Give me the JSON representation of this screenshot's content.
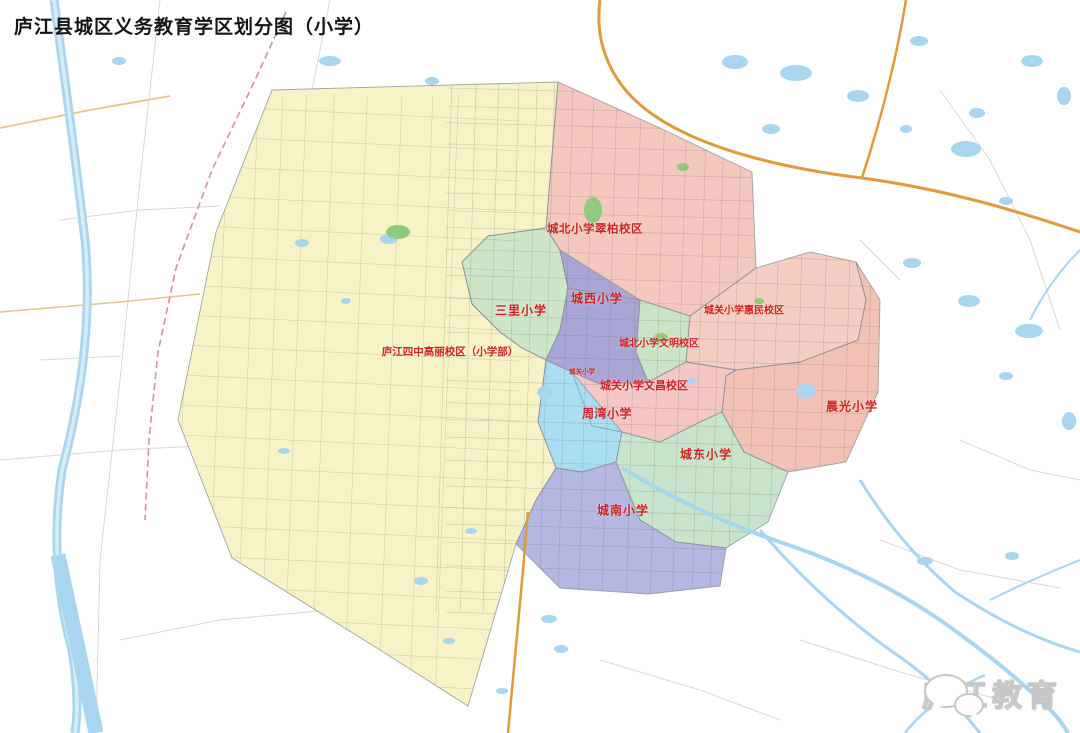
{
  "title": "庐江县城区义务教育学区划分图（小学）",
  "watermark": {
    "text": "庐江教育",
    "icon": "wechat-icon"
  },
  "palette": {
    "label_red": "#cc2222",
    "water": "#a8d5ef",
    "water_light": "#d6edf9",
    "green_patch": "#8fca7e",
    "road_orange": "#df9a3e",
    "road_ochre": "#e3c48c",
    "railway_pink": "#d98f98",
    "rural_road": "#d8d4c6",
    "zone_outline": "#8a8f9a",
    "title_color": "#141414"
  },
  "zones": [
    {
      "id": "sizhong",
      "school": "庐江四中高丽校区（小学部）",
      "color": "#f8f3c6",
      "label": {
        "x": 450,
        "y": 353,
        "size": 10.5,
        "spacing": 0
      },
      "points": "272,90 558,82 546,228 488,236 462,262 472,304 500,332 522,348 546,360 538,422 556,468 536,500 516,544 468,706 380,650 232,558 178,420 216,232"
    },
    {
      "id": "chengbei-cuibai",
      "school": "城北小学翠柏校区",
      "color": "#f4c8be",
      "label": {
        "x": 595,
        "y": 230,
        "size": 11.5,
        "spacing": 0.5
      },
      "points": "558,82 660,128 752,172 756,268 690,316 640,300 568,288 560,250 546,228"
    },
    {
      "id": "sanli",
      "school": "三里小学",
      "color": "#cee6c8",
      "label": {
        "x": 521,
        "y": 311,
        "size": 12,
        "spacing": 1
      },
      "points": "488,236 546,228 560,250 568,288 560,330 546,360 522,348 500,332 472,304 462,262"
    },
    {
      "id": "chengxi",
      "school": "城西小学",
      "color": "#a9a6d6",
      "label": {
        "x": 597,
        "y": 299,
        "size": 12,
        "spacing": 1
      },
      "points": "560,250 640,300 636,352 648,382 600,384 572,372 546,360 560,330 568,288"
    },
    {
      "id": "chengbei-wenming",
      "school": "城北小学文明校区",
      "color": "#cbe4c6",
      "label": {
        "x": 659,
        "y": 344,
        "size": 10,
        "spacing": 0
      },
      "points": "640,300 690,316 686,362 648,382 636,352"
    },
    {
      "id": "chengguan-huimin",
      "school": "城关小学惠民校区",
      "color": "#f5cdc2",
      "label": {
        "x": 744,
        "y": 311,
        "size": 10,
        "spacing": 0
      },
      "points": "756,268 810,252 856,262 866,300 858,340 800,362 736,370 686,362 690,316"
    },
    {
      "id": "chenguang",
      "school": "晨光小学",
      "color": "#f2c1b5",
      "label": {
        "x": 852,
        "y": 407,
        "size": 12,
        "spacing": 1
      },
      "points": "856,262 880,300 878,392 846,462 788,472 744,452 722,412 726,376 736,370 800,362 858,340 866,300"
    },
    {
      "id": "chengguan-wenchang",
      "school": "城关小学文昌校区",
      "color": "#f4c7c5",
      "label": {
        "x": 644,
        "y": 386,
        "size": 11,
        "spacing": 0
      },
      "points": "572,372 600,384 648,382 686,362 736,370 726,376 722,412 700,422 660,442 622,432 592,426"
    },
    {
      "id": "zhouwan",
      "school": "周湾小学",
      "color": "#a9def2",
      "label": {
        "x": 607,
        "y": 414,
        "size": 12,
        "spacing": 0.5
      },
      "points": "546,360 572,372 622,432 616,462 582,472 556,468 538,422"
    },
    {
      "id": "chengdong",
      "school": "城东小学",
      "color": "#c8e4cc",
      "label": {
        "x": 706,
        "y": 455,
        "size": 12,
        "spacing": 1
      },
      "points": "622,432 660,442 700,422 722,412 744,452 788,472 768,522 726,548 676,542 640,520 616,462"
    },
    {
      "id": "chengnan",
      "school": "城南小学",
      "color": "#b4b7e2",
      "label": {
        "x": 623,
        "y": 511,
        "size": 12,
        "spacing": 1
      },
      "points": "556,468 582,472 616,462 640,520 676,542 726,548 720,586 648,594 560,588 516,544 536,500"
    }
  ],
  "markers": [
    {
      "text": "城关小学",
      "x": 582,
      "y": 372,
      "size": 6.5
    }
  ]
}
